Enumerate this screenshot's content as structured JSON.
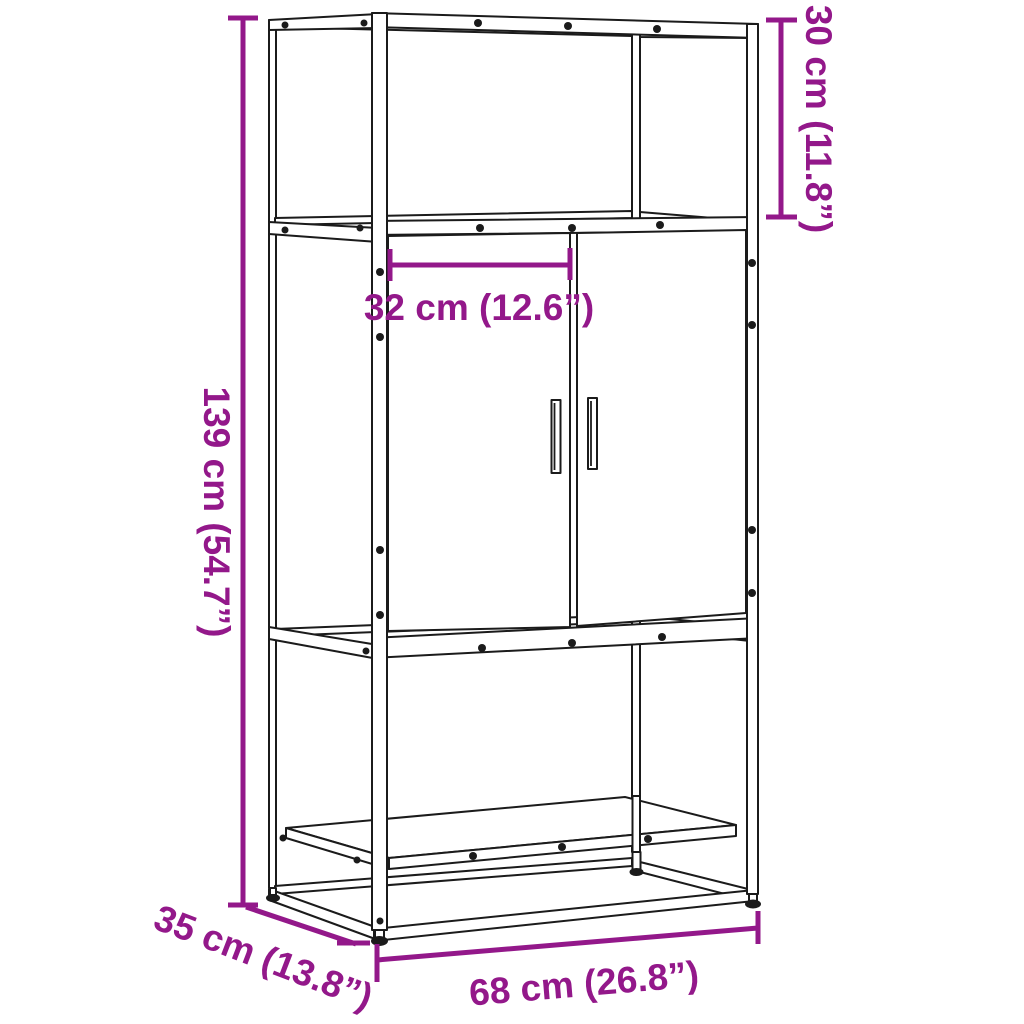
{
  "page": {
    "background": "#ffffff"
  },
  "diagram": {
    "title": "Cabinet dimension diagram",
    "product": "Highboard cabinet with 2 doors, open top compartment and lower shelf",
    "style": {
      "accent_color": "#93188A",
      "line_color": "#1b1b1b"
    },
    "dimensions": {
      "overall_height": {
        "label": "139 cm (54.7”)",
        "cm": 139,
        "inches": 54.7,
        "placement": "vertical-left"
      },
      "top_compartment_height": {
        "label": "30 cm (11.8”)",
        "cm": 30,
        "inches": 11.8,
        "placement": "vertical-right"
      },
      "door_width": {
        "label": "32 cm (12.6”)",
        "cm": 32,
        "inches": 12.6,
        "placement": "horizontal-upper-middle"
      },
      "overall_width": {
        "label": "68 cm (26.8”)",
        "cm": 68,
        "inches": 26.8,
        "placement": "bottom"
      },
      "depth": {
        "label": "35 cm (13.8”)",
        "cm": 35,
        "inches": 13.8,
        "placement": "diagonal-bottom-left"
      }
    }
  }
}
